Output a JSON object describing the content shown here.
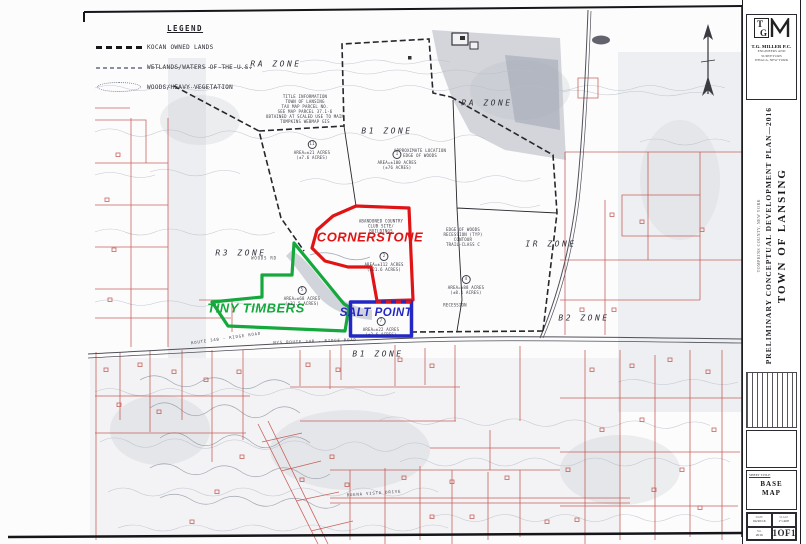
{
  "legend": {
    "title": "LEGEND",
    "items": [
      {
        "swatch": "black-dashed-line",
        "label": "KOCAN OWNED LANDS"
      },
      {
        "swatch": "dash-dot-line",
        "label": "WETLANDS/WATERS OF THE U.S."
      },
      {
        "swatch": "cloud-outline",
        "label": "WOODS/HEAVY VEGETATION"
      }
    ]
  },
  "map": {
    "zones": [
      {
        "label": "RA ZONE",
        "x": 276,
        "y": 64
      },
      {
        "label": "B1 ZONE",
        "x": 387,
        "y": 131
      },
      {
        "label": "RA ZONE",
        "x": 487,
        "y": 103
      },
      {
        "label": "R3 ZONE",
        "x": 241,
        "y": 253
      },
      {
        "label": "IR ZONE",
        "x": 551,
        "y": 244
      },
      {
        "label": "B2 ZONE",
        "x": 584,
        "y": 318
      },
      {
        "label": "B1 ZONE",
        "x": 378,
        "y": 354
      }
    ],
    "developments": [
      {
        "name": "CORNERSTONE",
        "color": "#e01414",
        "x": 370,
        "y": 237
      },
      {
        "name": "TINY TIMBERS",
        "color": "#15a83c",
        "x": 256,
        "y": 308
      },
      {
        "name": "SALT POINT",
        "color": "#2328c4",
        "x": 376,
        "y": 313
      }
    ],
    "roads": [
      {
        "name": "ROUTE 34B - RIDGE ROAD",
        "x": 226,
        "y": 338,
        "rot": -8
      },
      {
        "name": "NYS ROUTE 34B - RIDGE ROAD",
        "x": 315,
        "y": 341,
        "rot": -2
      },
      {
        "name": "BUENA VISTA DRIVE",
        "x": 374,
        "y": 493,
        "rot": -4
      },
      {
        "name": "WOODS RD",
        "x": 264,
        "y": 258,
        "rot": 0
      }
    ],
    "annotations": [
      {
        "text": "TITLE INFORMATION\nTOWN OF LANSING\nTAX MAP PARCEL NO.\nSEE MAP PARCEL 37.1-6\nOBTAINED AT SCALED USE TO MAIN\nTOMPKINS WEBMAP GIS",
        "x": 305,
        "y": 109
      },
      {
        "id": "1",
        "text": "AREA=±100 ACRES\n(±76 ACRES)",
        "x": 397,
        "y": 160
      },
      {
        "id": "11",
        "text": "AREA=±21 ACRES\n(±7.6 ACRES)",
        "x": 312,
        "y": 150
      },
      {
        "text": "ABANDONED COUNTRY\nCLUB SITE/\nBUILDINGS",
        "x": 381,
        "y": 226
      },
      {
        "id": "2",
        "text": "AREA=±112 ACRES\n(±21.6 ACRES)",
        "x": 384,
        "y": 262
      },
      {
        "id": "5",
        "text": "AREA=±68 ACRES\n(±31.5 ACRES)",
        "x": 302,
        "y": 296
      },
      {
        "id": "7",
        "text": "AREA=±22 ACRES\n(±2.6 ACRES)",
        "x": 381,
        "y": 327
      },
      {
        "text": "APPROXIMATE LOCATION\nEDGE OF WOODS",
        "x": 420,
        "y": 153
      },
      {
        "text": "EDGE OF WOODS\nRECESSION (TYP)\nCONTOUR\nTRAIL-CLASS C",
        "x": 463,
        "y": 237
      },
      {
        "id": "4",
        "text": "AREA=±88 ACRES\n(±8.1 ACRES)",
        "x": 466,
        "y": 285
      },
      {
        "text": "RECESSION",
        "x": 455,
        "y": 305
      }
    ]
  },
  "title_block": {
    "firm_name": "T.G. MILLER P.C.",
    "firm_sub1": "ENGINEERS AND SURVEYORS",
    "firm_sub2": "ITHACA, NEW YORK",
    "title_main": "TOWN OF LANSING",
    "title_sub": "PRELIMINARY CONCEPTUAL DEVELOPMENT PLAN—2016",
    "title_note": "TOMPKINS COUNTY, NEW YORK",
    "sheet_title_label": "SHEET TITLE",
    "sheet_title_line1": "BASE",
    "sheet_title_line2": "MAP",
    "date_label": "DATE",
    "date_value": "04/20/16",
    "scale_label": "SCALE",
    "scale_value": "1\"=400'",
    "no_label": "NO.",
    "no_value": "2016",
    "sheet_label": "SHEET",
    "sheet_value": "1OF1"
  }
}
